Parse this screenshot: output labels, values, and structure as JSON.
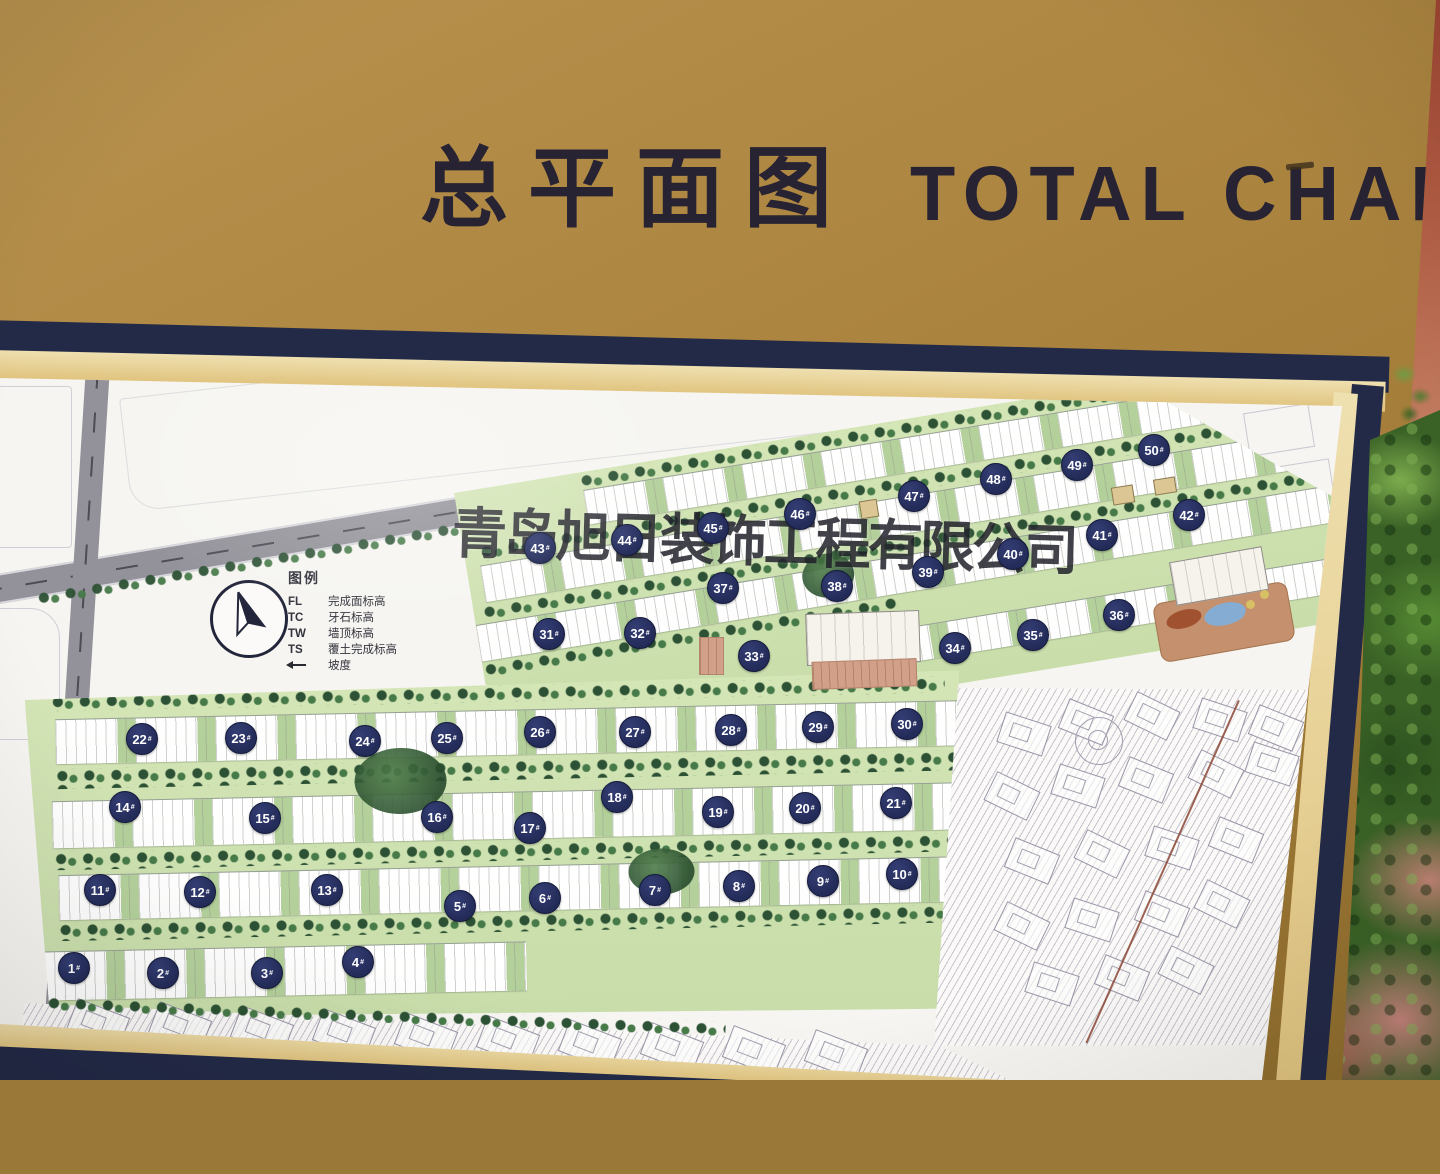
{
  "title": {
    "zh": "总平面图",
    "en": "TOTAL CHART"
  },
  "watermark": "青岛旭日装饰工程有限公司",
  "legend": {
    "title": "图例",
    "rows": [
      {
        "key": "FL",
        "icon": "",
        "desc": "完成面标高"
      },
      {
        "key": "TC",
        "icon": "",
        "desc": "牙石标高"
      },
      {
        "key": "TW",
        "icon": "",
        "desc": "墙顶标高"
      },
      {
        "key": "TS",
        "icon": "",
        "desc": "覆土完成标高"
      },
      {
        "key": "",
        "icon": "slope-arrow",
        "desc": "坡度"
      }
    ]
  },
  "map": {
    "unit_suffix": "#",
    "buildings": [
      {
        "n": "1",
        "x": 74,
        "y": 968
      },
      {
        "n": "2",
        "x": 163,
        "y": 973
      },
      {
        "n": "3",
        "x": 267,
        "y": 973
      },
      {
        "n": "4",
        "x": 358,
        "y": 962
      },
      {
        "n": "5",
        "x": 460,
        "y": 906
      },
      {
        "n": "6",
        "x": 545,
        "y": 898
      },
      {
        "n": "7",
        "x": 655,
        "y": 890
      },
      {
        "n": "8",
        "x": 739,
        "y": 886
      },
      {
        "n": "9",
        "x": 823,
        "y": 881
      },
      {
        "n": "10",
        "x": 902,
        "y": 874
      },
      {
        "n": "11",
        "x": 100,
        "y": 890
      },
      {
        "n": "12",
        "x": 200,
        "y": 892
      },
      {
        "n": "13",
        "x": 327,
        "y": 890
      },
      {
        "n": "14",
        "x": 125,
        "y": 807
      },
      {
        "n": "15",
        "x": 265,
        "y": 818
      },
      {
        "n": "16",
        "x": 437,
        "y": 817
      },
      {
        "n": "17",
        "x": 530,
        "y": 828
      },
      {
        "n": "18",
        "x": 617,
        "y": 797
      },
      {
        "n": "19",
        "x": 718,
        "y": 812
      },
      {
        "n": "20",
        "x": 805,
        "y": 808
      },
      {
        "n": "21",
        "x": 896,
        "y": 803
      },
      {
        "n": "22",
        "x": 142,
        "y": 739
      },
      {
        "n": "23",
        "x": 241,
        "y": 738
      },
      {
        "n": "24",
        "x": 365,
        "y": 741
      },
      {
        "n": "25",
        "x": 447,
        "y": 738
      },
      {
        "n": "26",
        "x": 540,
        "y": 732
      },
      {
        "n": "27",
        "x": 635,
        "y": 732
      },
      {
        "n": "28",
        "x": 731,
        "y": 730
      },
      {
        "n": "29",
        "x": 818,
        "y": 727
      },
      {
        "n": "30",
        "x": 907,
        "y": 724
      },
      {
        "n": "31",
        "x": 549,
        "y": 634
      },
      {
        "n": "32",
        "x": 640,
        "y": 633
      },
      {
        "n": "33",
        "x": 754,
        "y": 656
      },
      {
        "n": "34",
        "x": 955,
        "y": 648
      },
      {
        "n": "35",
        "x": 1033,
        "y": 635
      },
      {
        "n": "36",
        "x": 1119,
        "y": 615
      },
      {
        "n": "37",
        "x": 723,
        "y": 588
      },
      {
        "n": "38",
        "x": 837,
        "y": 586
      },
      {
        "n": "39",
        "x": 928,
        "y": 572
      },
      {
        "n": "40",
        "x": 1013,
        "y": 554
      },
      {
        "n": "41",
        "x": 1102,
        "y": 535
      },
      {
        "n": "42",
        "x": 1189,
        "y": 515
      },
      {
        "n": "43",
        "x": 540,
        "y": 548
      },
      {
        "n": "44",
        "x": 627,
        "y": 540
      },
      {
        "n": "45",
        "x": 713,
        "y": 528
      },
      {
        "n": "46",
        "x": 800,
        "y": 514
      },
      {
        "n": "47",
        "x": 914,
        "y": 496
      },
      {
        "n": "48",
        "x": 996,
        "y": 479
      },
      {
        "n": "49",
        "x": 1077,
        "y": 465
      },
      {
        "n": "50",
        "x": 1154,
        "y": 450
      }
    ]
  },
  "colors": {
    "board_gold": "#ac8540",
    "frame_navy": "#232a47",
    "mat_cream": "#e7d29a",
    "paper": "#f6f5f1",
    "marker_navy": "#232b58",
    "site_green": "#cde0ae",
    "wall_terracotta": "#b05a42"
  }
}
